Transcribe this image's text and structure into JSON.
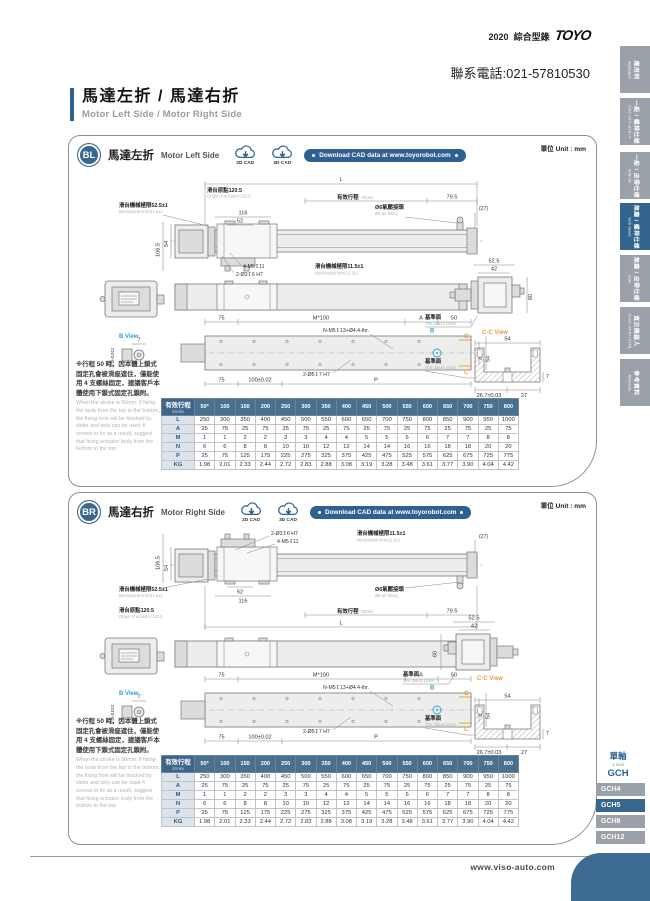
{
  "page": {
    "catalog_year": "2020",
    "catalog_label": "綜合型錄",
    "brand": "TOYO",
    "phone": "聯系電話:021-57810530",
    "title_zh": "馬達左折 / 馬達右折",
    "title_en": "Motor Left Side / Motor Right Side",
    "footer_url": "www.viso-auto.com"
  },
  "sidebar": {
    "tabs": [
      {
        "zh": "應用例",
        "en": "Application",
        "active": false
      },
      {
        "zh": "一般 / 螺桿仕樣",
        "en": "GTH / GTY / ETH / Y",
        "active": false
      },
      {
        "zh": "一般 / 皮帶仕樣",
        "en": "ETB / M",
        "active": false
      },
      {
        "zh": "無塵 / 螺桿仕樣",
        "en": "GCH Series",
        "active": true
      },
      {
        "zh": "無塵 / 皮帶仕樣",
        "en": "ECB",
        "active": false
      },
      {
        "zh": "直交機器人",
        "en": "XYGT / XYTH / XYTB",
        "active": false
      },
      {
        "zh": "參考資料",
        "en": "Reference",
        "active": false
      }
    ]
  },
  "axis_nav": {
    "group_zh": "單軸",
    "group_en": "1 axis",
    "series": "GCH",
    "items": [
      {
        "label": "GCH4",
        "active": false
      },
      {
        "label": "GCH5",
        "active": true
      },
      {
        "label": "GCH8",
        "active": false
      },
      {
        "label": "GCH12",
        "active": false
      }
    ]
  },
  "sections": {
    "bl": {
      "badge": "BL",
      "title_zh": "馬達左折",
      "title_en": "Motor Left Side",
      "unit": "單位 Unit : mm",
      "cad2d": "2D CAD",
      "cad3d": "3D CAD",
      "download": "Download CAD data at www.toyorobot.com"
    },
    "br": {
      "badge": "BR",
      "title_zh": "馬達右折",
      "title_en": "Motor Right Side",
      "unit": "單位 Unit : mm",
      "cad2d": "2D CAD",
      "cad3d": "3D CAD",
      "download": "Download CAD data at www.toyorobot.com"
    }
  },
  "notes": {
    "zh": "※行程 50 時，因本體上鎖式固定孔會被滑座遮住，僅能使用 4 支螺絲固定，建議客戶本體使用下鎖式固定孔鎖附。",
    "en": "When the stroke is 50mm, if fixing the body from the top to the bottom, the fixing hole will be blocked by slider and only can be used 4 screws to fix as a result, suggest that fixing actuator body from the bottom to the top."
  },
  "dw": {
    "l": "L",
    "origin_zh": "滑台原點120.5",
    "origin_en": "Origin of actuator:120.5",
    "stroke_zh": "有效行程",
    "stroke_en": "Stroke",
    "d795": "79.5",
    "mech52_zh": "滑台機械極限52.5±1",
    "mech52_en": "Mechanical limit:52.5±1",
    "d116": "116",
    "d52": "52",
    "air_zh": "Ø6氣壓接頭",
    "air_en": "Ø6 air fitting",
    "d27p": "(27)",
    "d1065": "106.5",
    "d54": "54",
    "m5x11": "4-M5↧11",
    "hole36": "2-Ø3↧6 H7",
    "mech115_zh": "滑台機械極限11.5±1",
    "mech115_en": "Mechanical limit:11.5±1",
    "d525": "52.5",
    "d42": "42",
    "d60": "60",
    "datum_zh": "基準面",
    "datum_en": "The datum plane",
    "cc": "C-C View",
    "d267": "26.7±0.03",
    "d27": "27",
    "d7": "7",
    "d75": "75",
    "m100": "M*100",
    "a": "A",
    "d50": "50",
    "nm5": "N-M5↧13+Ø4.4-thr.",
    "bview": "B View",
    "tol": "5 0/-0.012",
    "d100": "100±0.02",
    "hole57": "2-Ø5↧7 H7",
    "p": "P",
    "b": "B",
    "c": "C",
    "d45": "45"
  },
  "table": {
    "header_zh": "有效行程",
    "header_en": "Stroke",
    "strokes": [
      "50*",
      "100",
      "150",
      "200",
      "250",
      "300",
      "350",
      "400",
      "450",
      "500",
      "550",
      "600",
      "650",
      "700",
      "750",
      "800"
    ],
    "rows": [
      {
        "label": "L",
        "values": [
          "250",
          "300",
          "350",
          "400",
          "450",
          "500",
          "550",
          "600",
          "650",
          "700",
          "750",
          "800",
          "850",
          "900",
          "950",
          "1000"
        ]
      },
      {
        "label": "A",
        "values": [
          "25",
          "75",
          "25",
          "75",
          "25",
          "75",
          "25",
          "75",
          "25",
          "75",
          "25",
          "75",
          "25",
          "75",
          "25",
          "75"
        ]
      },
      {
        "label": "M",
        "values": [
          "1",
          "1",
          "2",
          "2",
          "3",
          "3",
          "4",
          "4",
          "5",
          "5",
          "6",
          "6",
          "7",
          "7",
          "8",
          "8"
        ]
      },
      {
        "label": "N",
        "values": [
          "6",
          "6",
          "8",
          "8",
          "10",
          "10",
          "12",
          "12",
          "14",
          "14",
          "16",
          "16",
          "18",
          "18",
          "20",
          "20"
        ]
      },
      {
        "label": "P",
        "values": [
          "25",
          "75",
          "125",
          "175",
          "225",
          "275",
          "325",
          "375",
          "425",
          "475",
          "525",
          "575",
          "625",
          "675",
          "725",
          "775"
        ]
      },
      {
        "label": "KG",
        "values": [
          "1.98",
          "2.01",
          "2.33",
          "2.44",
          "2.72",
          "2.83",
          "2.88",
          "3.08",
          "3.19",
          "3.28",
          "3.48",
          "3.61",
          "3.77",
          "3.90",
          "4.04",
          "4.42"
        ]
      }
    ]
  }
}
